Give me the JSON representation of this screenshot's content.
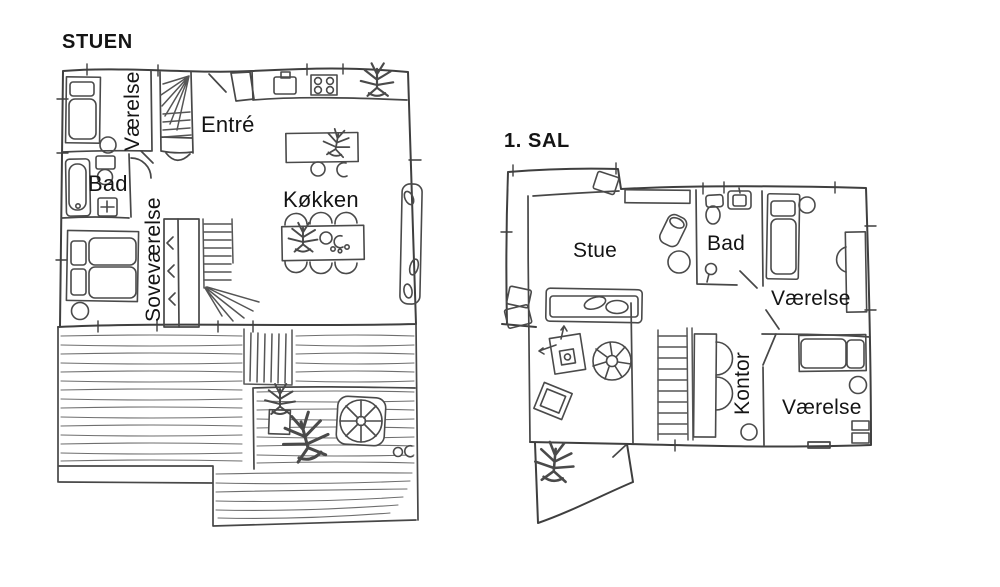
{
  "colors": {
    "ink": "#3f3f3f",
    "furniture": "#4a4a4a",
    "plank": "#6e6e6e",
    "label": "#141414",
    "background": "#ffffff"
  },
  "plans": {
    "ground": {
      "title": "STUEN",
      "rooms": {
        "vaerelse": "Værelse",
        "entre": "Entré",
        "bad": "Bad",
        "sovevaerelse": "Soveværelse",
        "koekken": "Køkken"
      }
    },
    "first": {
      "title": "1. SAL",
      "rooms": {
        "stue": "Stue",
        "bad": "Bad",
        "vaerelse_front": "Værelse",
        "kontor": "Kontor",
        "vaerelse_back": "Værelse"
      }
    }
  }
}
